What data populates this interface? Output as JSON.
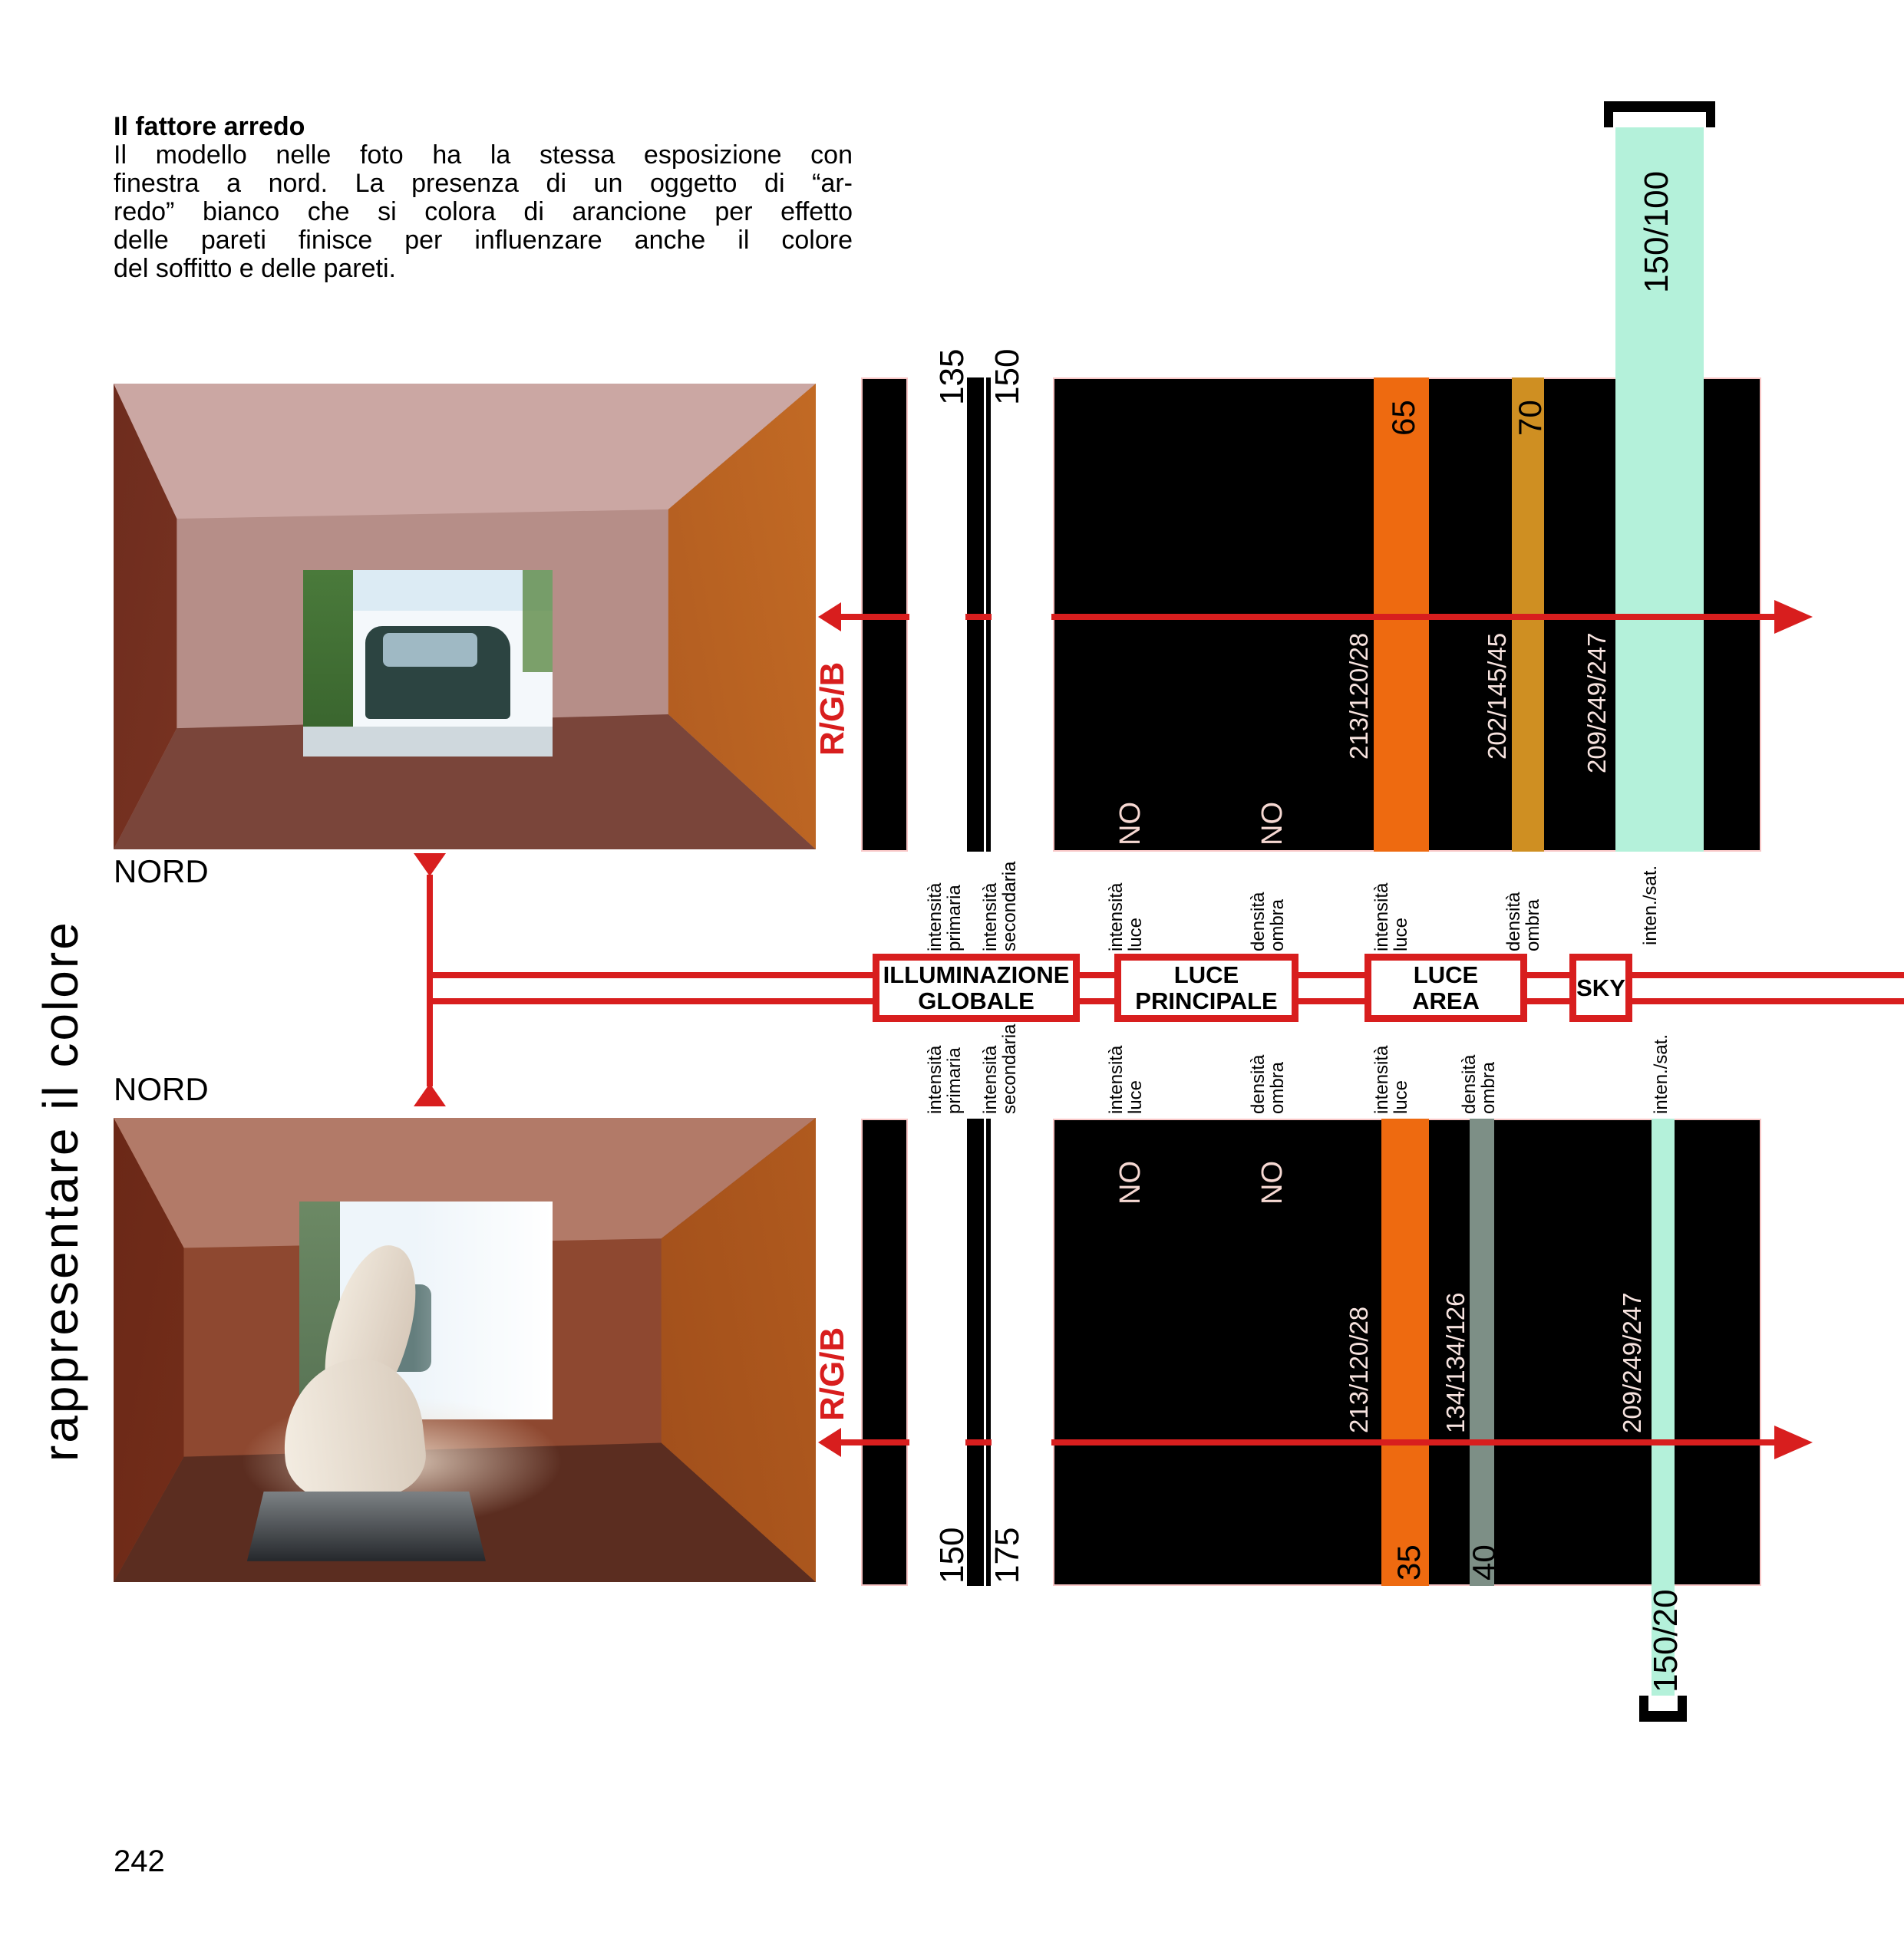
{
  "sidebar": {
    "vertical_text": "rappresentare il colore"
  },
  "article": {
    "heading": "Il fattore arredo",
    "lines": [
      "Il modello nelle foto ha la stessa esposizione con",
      "finestra a nord. La presenza di un oggetto di “ar-",
      "redo” bianco che si colora di arancione per effetto",
      "delle pareti finisce per influenzare anche il colore",
      "del soffitto e delle pareti."
    ]
  },
  "photos": {
    "top_label": "NORD",
    "bottom_label": "NORD"
  },
  "axis": {
    "intensita": "intensità",
    "primaria": "primaria",
    "secondaria": "secondaria",
    "luce": "luce",
    "densita": "densità",
    "ombra": "ombra",
    "inten_sat": "inten./sat.",
    "no": "NO",
    "rgb_marker": "R/G/B"
  },
  "flow_boxes": {
    "b1l1": "ILLUMINAZIONE",
    "b1l2": "GLOBALE",
    "b2l1": "LUCE",
    "b2l2": "PRINCIPALE",
    "b3l1": "LUCE",
    "b3l2": "AREA",
    "b4l1": "SKY"
  },
  "top_diagram": {
    "primary_intensity": "135",
    "secondary_intensity": "150",
    "light_value": "65",
    "light_rgb": "213/120/28",
    "shadow_value": "70",
    "shadow_rgb": "202/145/45",
    "sky_rgb": "209/249/247",
    "sky_intensity_saturation": "150/100"
  },
  "bottom_diagram": {
    "primary_intensity": "150",
    "secondary_intensity": "175",
    "light_value": "35",
    "light_rgb": "213/120/28",
    "shadow_value": "40",
    "shadow_rgb": "134/134/126",
    "sky_rgb": "209/249/247",
    "sky_intensity_saturation": "150/20"
  },
  "footer": {
    "page_number": "242"
  },
  "colors": {
    "accent_red": "#d81e1e",
    "bar_orange": "#ee6a10",
    "bar_amber": "#cf8f22",
    "bar_gray": "#7d8f86",
    "bar_mint": "#b4f1da",
    "panel_black": "#000000",
    "pale_text": "#f7e3df"
  }
}
